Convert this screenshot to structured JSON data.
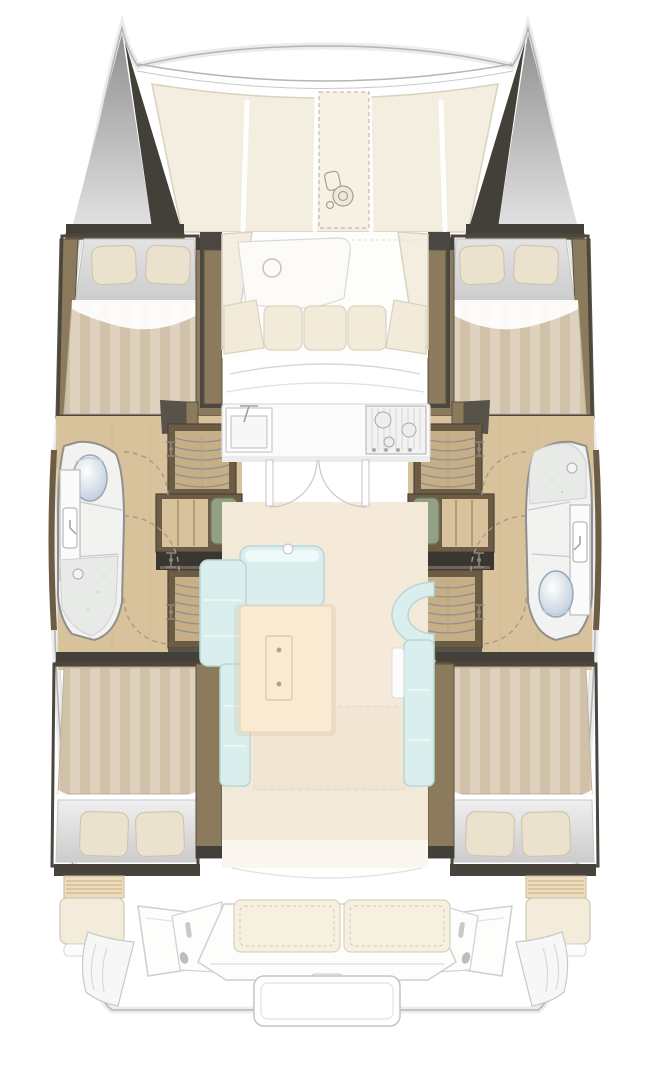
{
  "meta": {
    "type": "floor-plan",
    "subject": "catamaran interior deck plan, top view",
    "orientation": "bow-up",
    "background": "#ffffff"
  },
  "palette": {
    "paper": "#ffffff",
    "line": "#b3b3b3",
    "line-soft": "#e9e9e9",
    "dark": "#43403a",
    "dark2": "#57534b",
    "wood": "#8b7a5b",
    "wood-dark": "#6b5c43",
    "wood-light": "#c6af87",
    "floor-wood": "#d8c29c",
    "deck-cream": "#f3eedf",
    "deck-cream-line": "#d9d2bf",
    "cushion": "#f2ebd9",
    "saloon-floor": "#f3e9d8",
    "table": "#f9ead1",
    "aqua": "#d9eeed",
    "aqua-line": "#b7d7d5",
    "aqua-hi": "#eefaf9",
    "stripe-a": "#ded2bf",
    "stripe-b": "#d0c1a8",
    "sheet": "#d6d6d6",
    "pillow": "#ebe2cd",
    "fixture": "#f2f2f0",
    "fixture-line": "#8f8f8f",
    "shower": "#e8eae8",
    "toilet": "#b6c6d8",
    "green": "#93a083",
    "dash": "#a89a82"
  },
  "rooms": [
    {
      "id": "foredeck",
      "features": [
        "bow-tips",
        "crossbeam",
        "deck-panels",
        "anchor-locker",
        "windlass"
      ]
    },
    {
      "id": "forward-cockpit",
      "features": [
        "deck-hatch",
        "u-shaped-cushioned-bench"
      ]
    },
    {
      "id": "forward-cabin-port",
      "features": [
        "double-bed",
        "two-pillows",
        "striped-duvet",
        "wardrobe"
      ]
    },
    {
      "id": "forward-cabin-starboard",
      "features": [
        "double-bed",
        "two-pillows",
        "striped-duvet",
        "wardrobe"
      ]
    },
    {
      "id": "bathroom-port",
      "features": [
        "toilet",
        "sink",
        "shower-with-drain",
        "door-swing"
      ]
    },
    {
      "id": "bathroom-starboard",
      "features": [
        "shower-with-drain",
        "sink",
        "toilet",
        "door-swing"
      ]
    },
    {
      "id": "companionway-port",
      "features": [
        "steps",
        "two-wardrobes",
        "door-swings"
      ]
    },
    {
      "id": "companionway-starboard",
      "features": [
        "steps",
        "two-wardrobes",
        "door-swings"
      ]
    },
    {
      "id": "galley",
      "features": [
        "sink-with-faucet",
        "stove",
        "counter",
        "two-doors-with-swings"
      ]
    },
    {
      "id": "saloon",
      "features": [
        "l-shaped-sofa",
        "coffee-table",
        "curved-seat",
        "side-bench"
      ]
    },
    {
      "id": "aft-cabin-port",
      "features": [
        "double-bed",
        "two-pillows",
        "striped-duvet"
      ]
    },
    {
      "id": "aft-cabin-starboard",
      "features": [
        "double-bed",
        "two-pillows",
        "striped-duvet"
      ]
    },
    {
      "id": "aft-cockpit",
      "features": [
        "bench-two-cushions",
        "helm-seat-port",
        "helm-seat-starboard",
        "consoles",
        "transom-steps",
        "swim-platform"
      ]
    }
  ],
  "counts": {
    "hulls": 2,
    "cabins": 4,
    "bathrooms": 2
  }
}
